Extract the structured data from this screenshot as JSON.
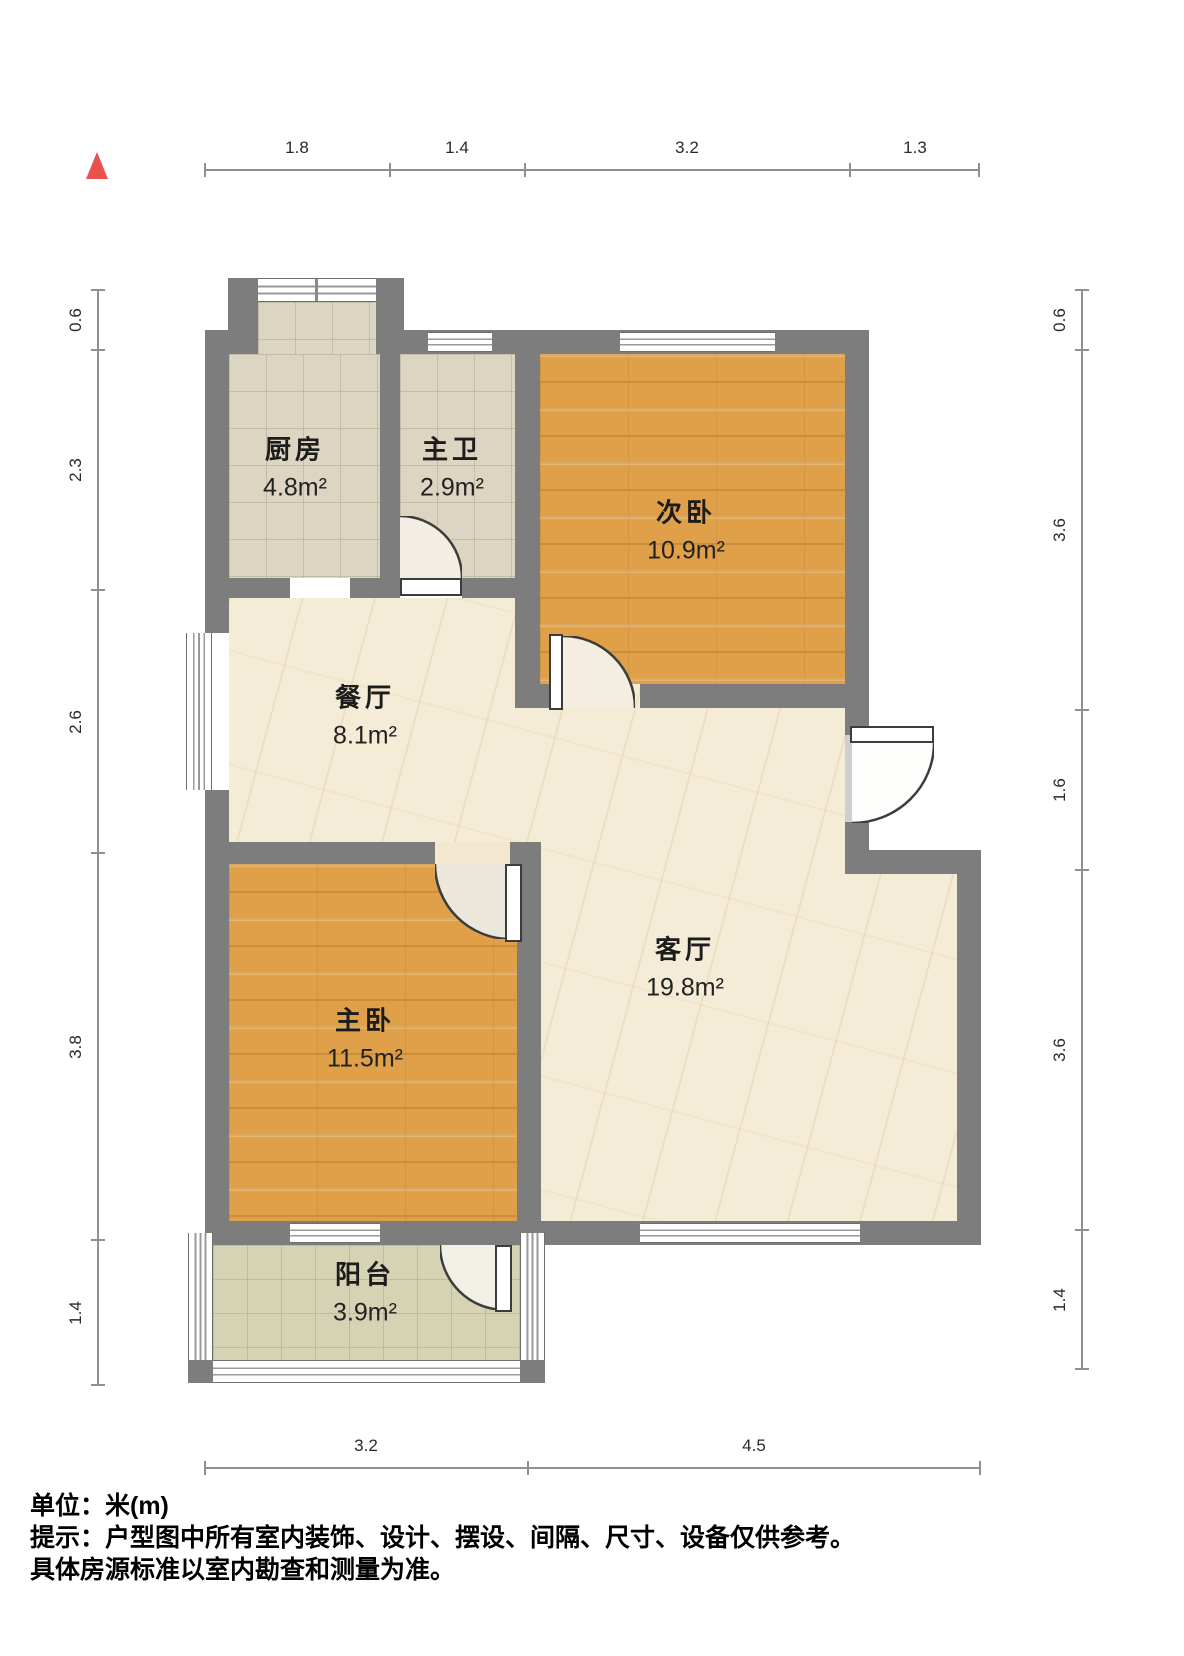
{
  "title": "户型图",
  "rooms": [
    {
      "id": "kitchen",
      "name": "厨房",
      "area": "4.8m²"
    },
    {
      "id": "master-bath",
      "name": "主卫",
      "area": "2.9m²"
    },
    {
      "id": "second-bedroom",
      "name": "次卧",
      "area": "10.9m²"
    },
    {
      "id": "dining-room",
      "name": "餐厅",
      "area": "8.1m²"
    },
    {
      "id": "living-room",
      "name": "客厅",
      "area": "19.8m²"
    },
    {
      "id": "master-bedroom",
      "name": "主卧",
      "area": "11.5m²"
    },
    {
      "id": "balcony",
      "name": "阳台",
      "area": "3.9m²"
    }
  ],
  "dimensions": {
    "unit": "m",
    "top": [
      "1.8",
      "1.4",
      "3.2",
      "1.3"
    ],
    "bottom": [
      "3.2",
      "4.5"
    ],
    "left": [
      "0.6",
      "2.3",
      "2.6",
      "3.8",
      "1.4"
    ],
    "right": [
      "0.6",
      "3.6",
      "1.6",
      "3.6",
      "1.4"
    ]
  },
  "footer": {
    "unit_label": "单位：米(m)",
    "notice_line1": "提示：户型图中所有室内装饰、设计、摆设、间隔、尺寸、设备仅供参考。",
    "notice_line2": "具体房源标准以室内勘查和测量为准。"
  },
  "colors": {
    "wall": "#7d7d7d",
    "wood_floor": "#dfa049",
    "marble_floor": "#f4ecd6",
    "tile_floor": "#dbd5c1",
    "balcony_tile": "#d6d3b5",
    "north_arrow": "#e8514d",
    "dimension_line": "#8f8f8f"
  }
}
